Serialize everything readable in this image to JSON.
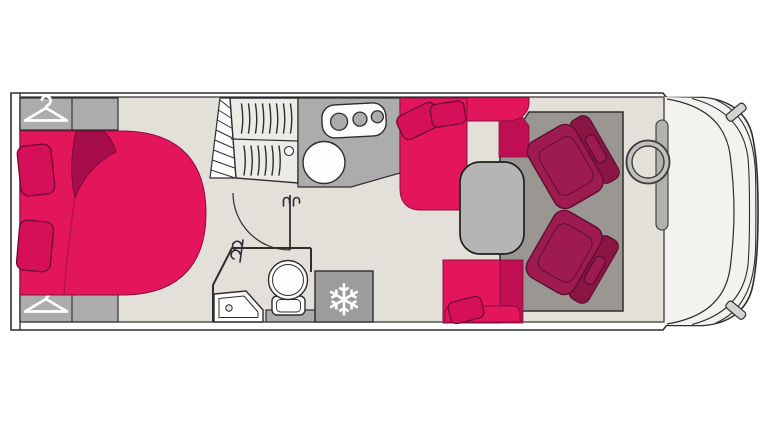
{
  "title": "",
  "colors": {
    "outline": "#2e2e2e",
    "floor": "#e3e0da",
    "cab_floor": "#f4f2ef",
    "cabinet": "#acacac",
    "fridge": "#9c9c9c",
    "table": "#b5b5b5",
    "mat": "#9a9691",
    "pink": "#e3155b",
    "pink_mid": "#d61058",
    "pink_dark": "#c00e52",
    "pink_deep": "#a60d49",
    "pink_edge": "#8a0e3f",
    "pink_deep_edge": "#6f0931",
    "chair": "#9e1b50",
    "chair_dark": "#8a1543",
    "chair_edge": "#5c0f33",
    "icon_white": "#ffffff"
  },
  "icons": {
    "snowflake_glyph": "❄",
    "names": [
      "hanger-icon",
      "snowflake-icon",
      "stove-burners-icon",
      "steering-wheel-icon"
    ]
  }
}
